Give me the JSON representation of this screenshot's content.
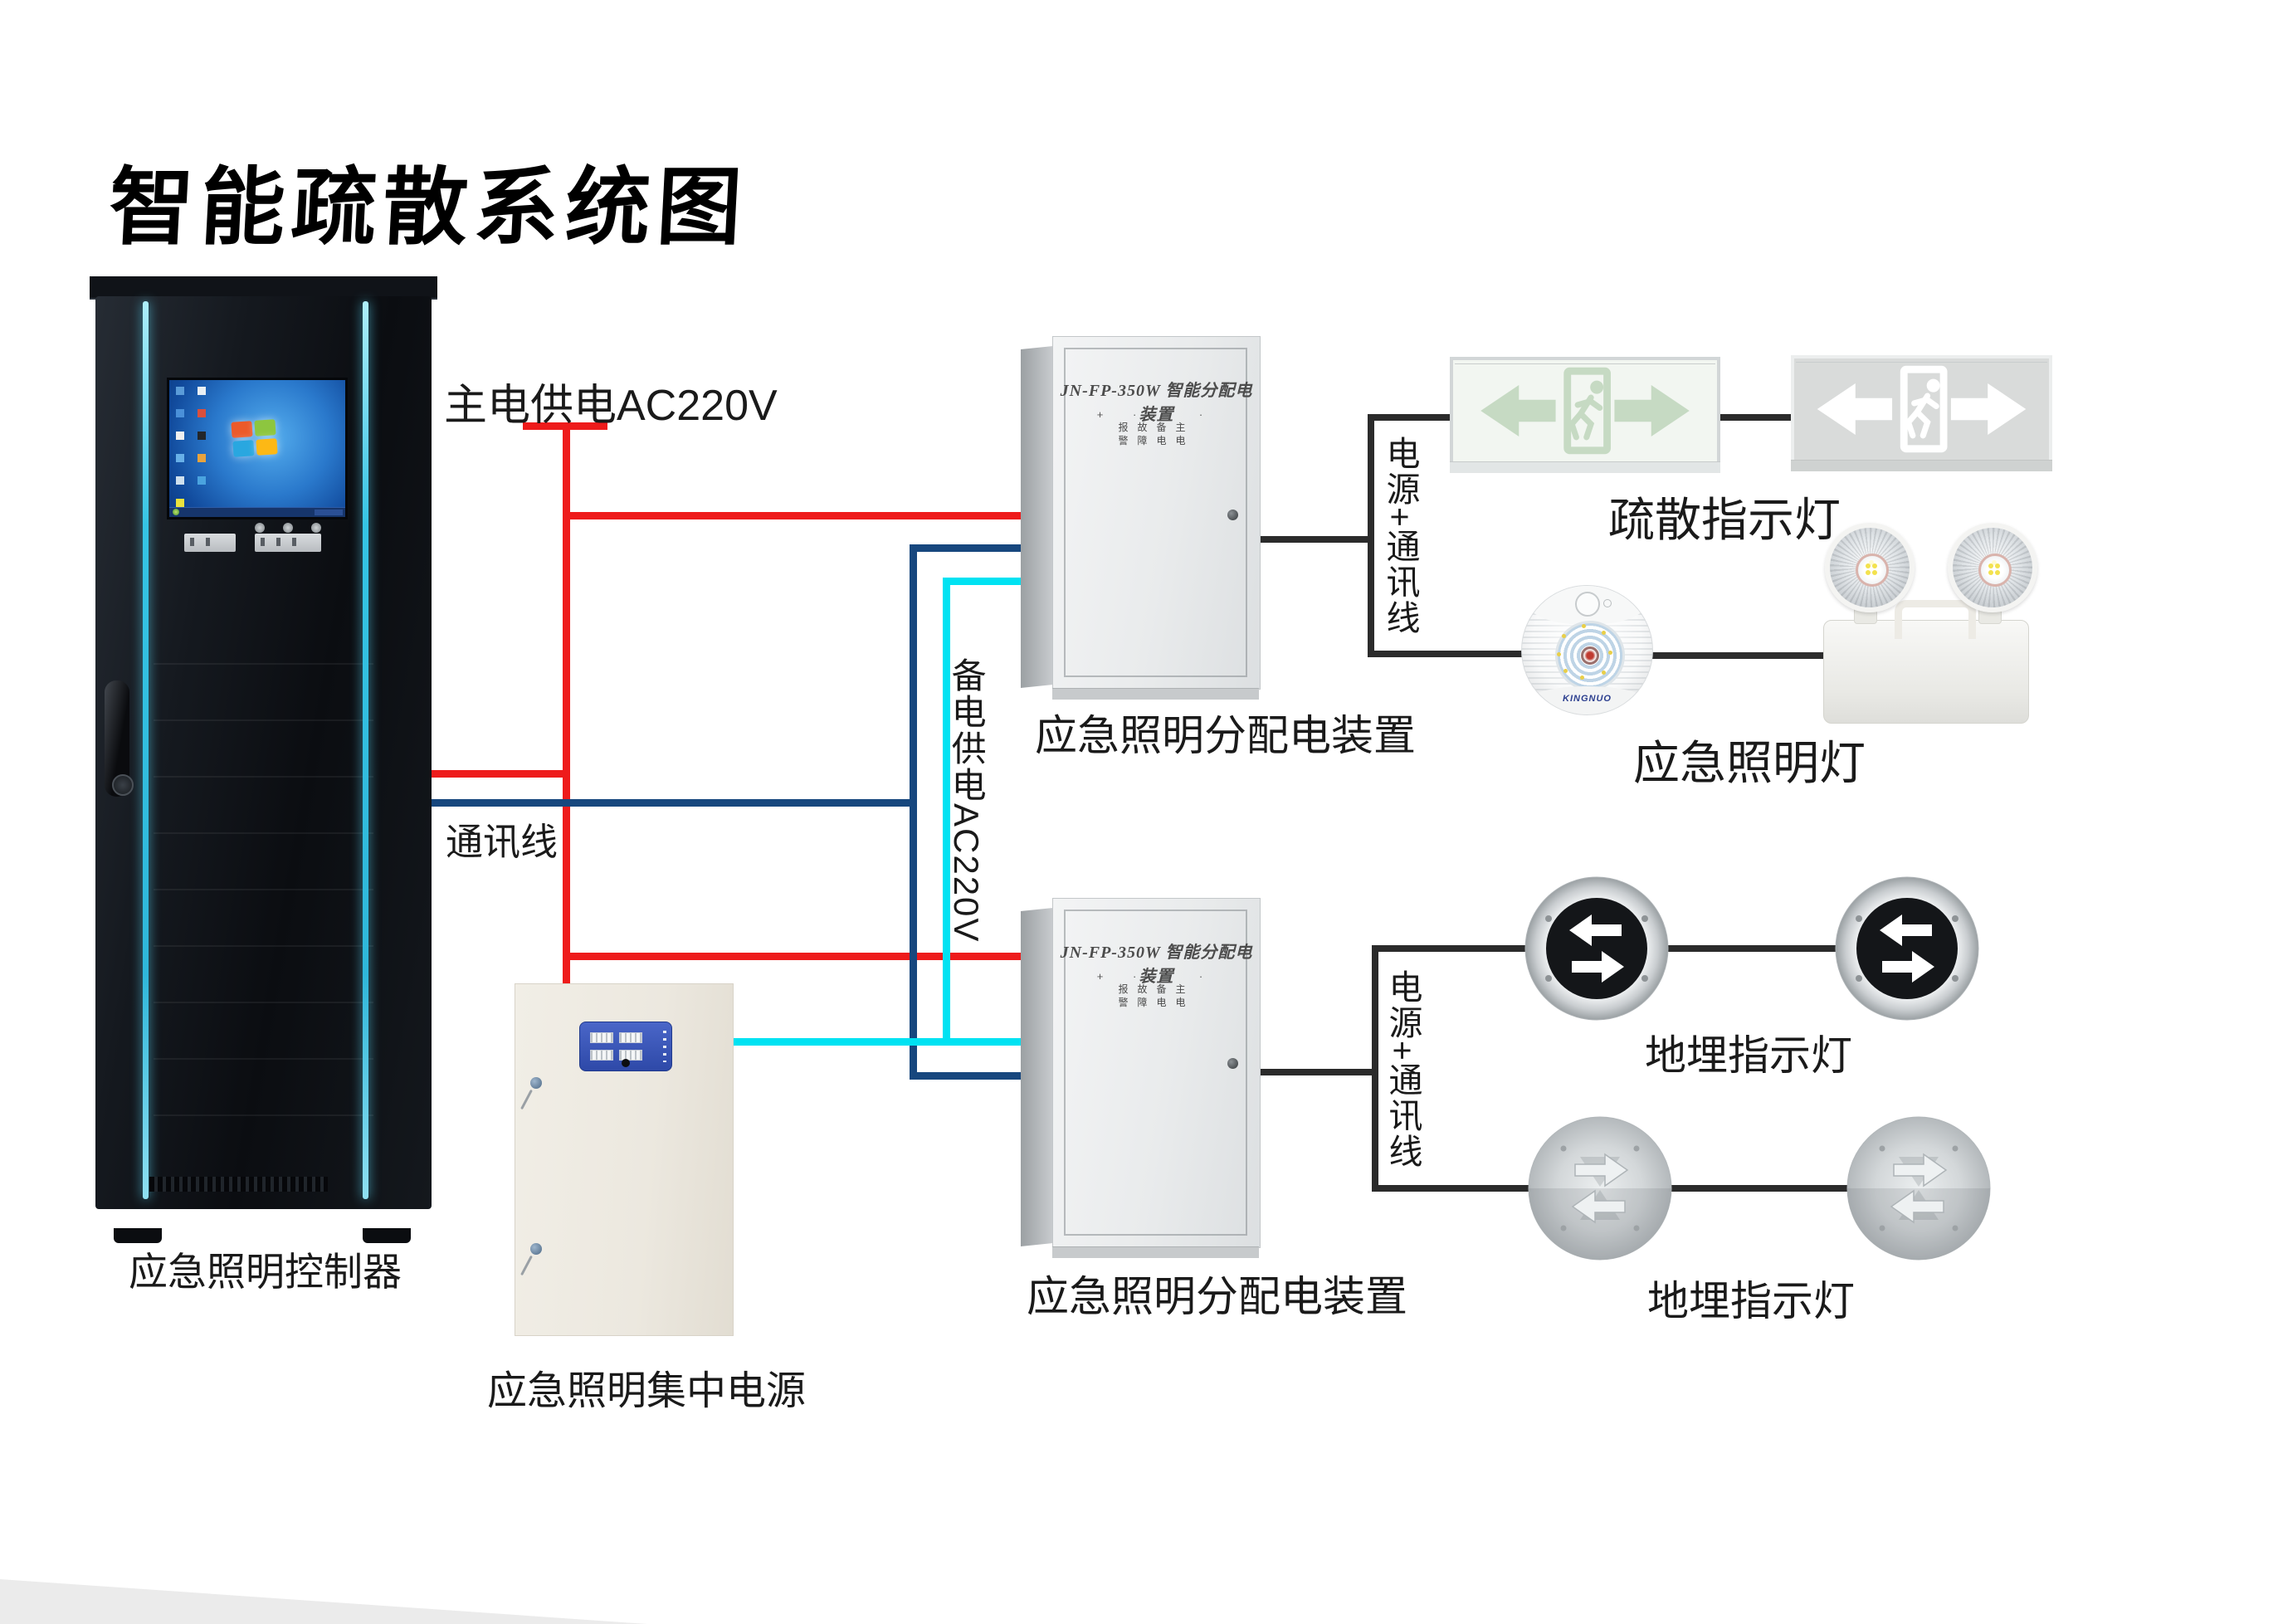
{
  "title": "智能疏散系统图",
  "wiring": {
    "main_power_label": "主电供电AC220V",
    "comm_label": "通讯线",
    "backup_power_label": "备电供电AC220V",
    "power_comm_top": "电源+通讯线",
    "power_comm_bottom": "电源+通讯线",
    "colors": {
      "main_power": "#ee1b1b",
      "communication": "#17477e",
      "backup_power": "#00e2f2",
      "device_link": "#2b2b2b"
    }
  },
  "devices": {
    "controller": {
      "label": "应急照明控制器"
    },
    "central_power": {
      "label": "应急照明集中电源"
    },
    "dist_box_top": {
      "label": "应急照明分配电装置",
      "panel_title": "JN-FP-350W 智能分配电装置",
      "led_row1": "报故备主",
      "led_row2": "警障电电"
    },
    "dist_box_bottom": {
      "label": "应急照明分配电装置",
      "panel_title": "JN-FP-350W 智能分配电装置",
      "led_row1": "报故备主",
      "led_row2": "警障电电"
    },
    "exit_signs": {
      "label": "疏散指示灯"
    },
    "emergency_lights": {
      "label": "应急照明灯",
      "brand": "KINGNUO"
    },
    "ground_lights_top": {
      "label": "地埋指示灯"
    },
    "ground_lights_bottom": {
      "label": "地埋指示灯"
    }
  }
}
